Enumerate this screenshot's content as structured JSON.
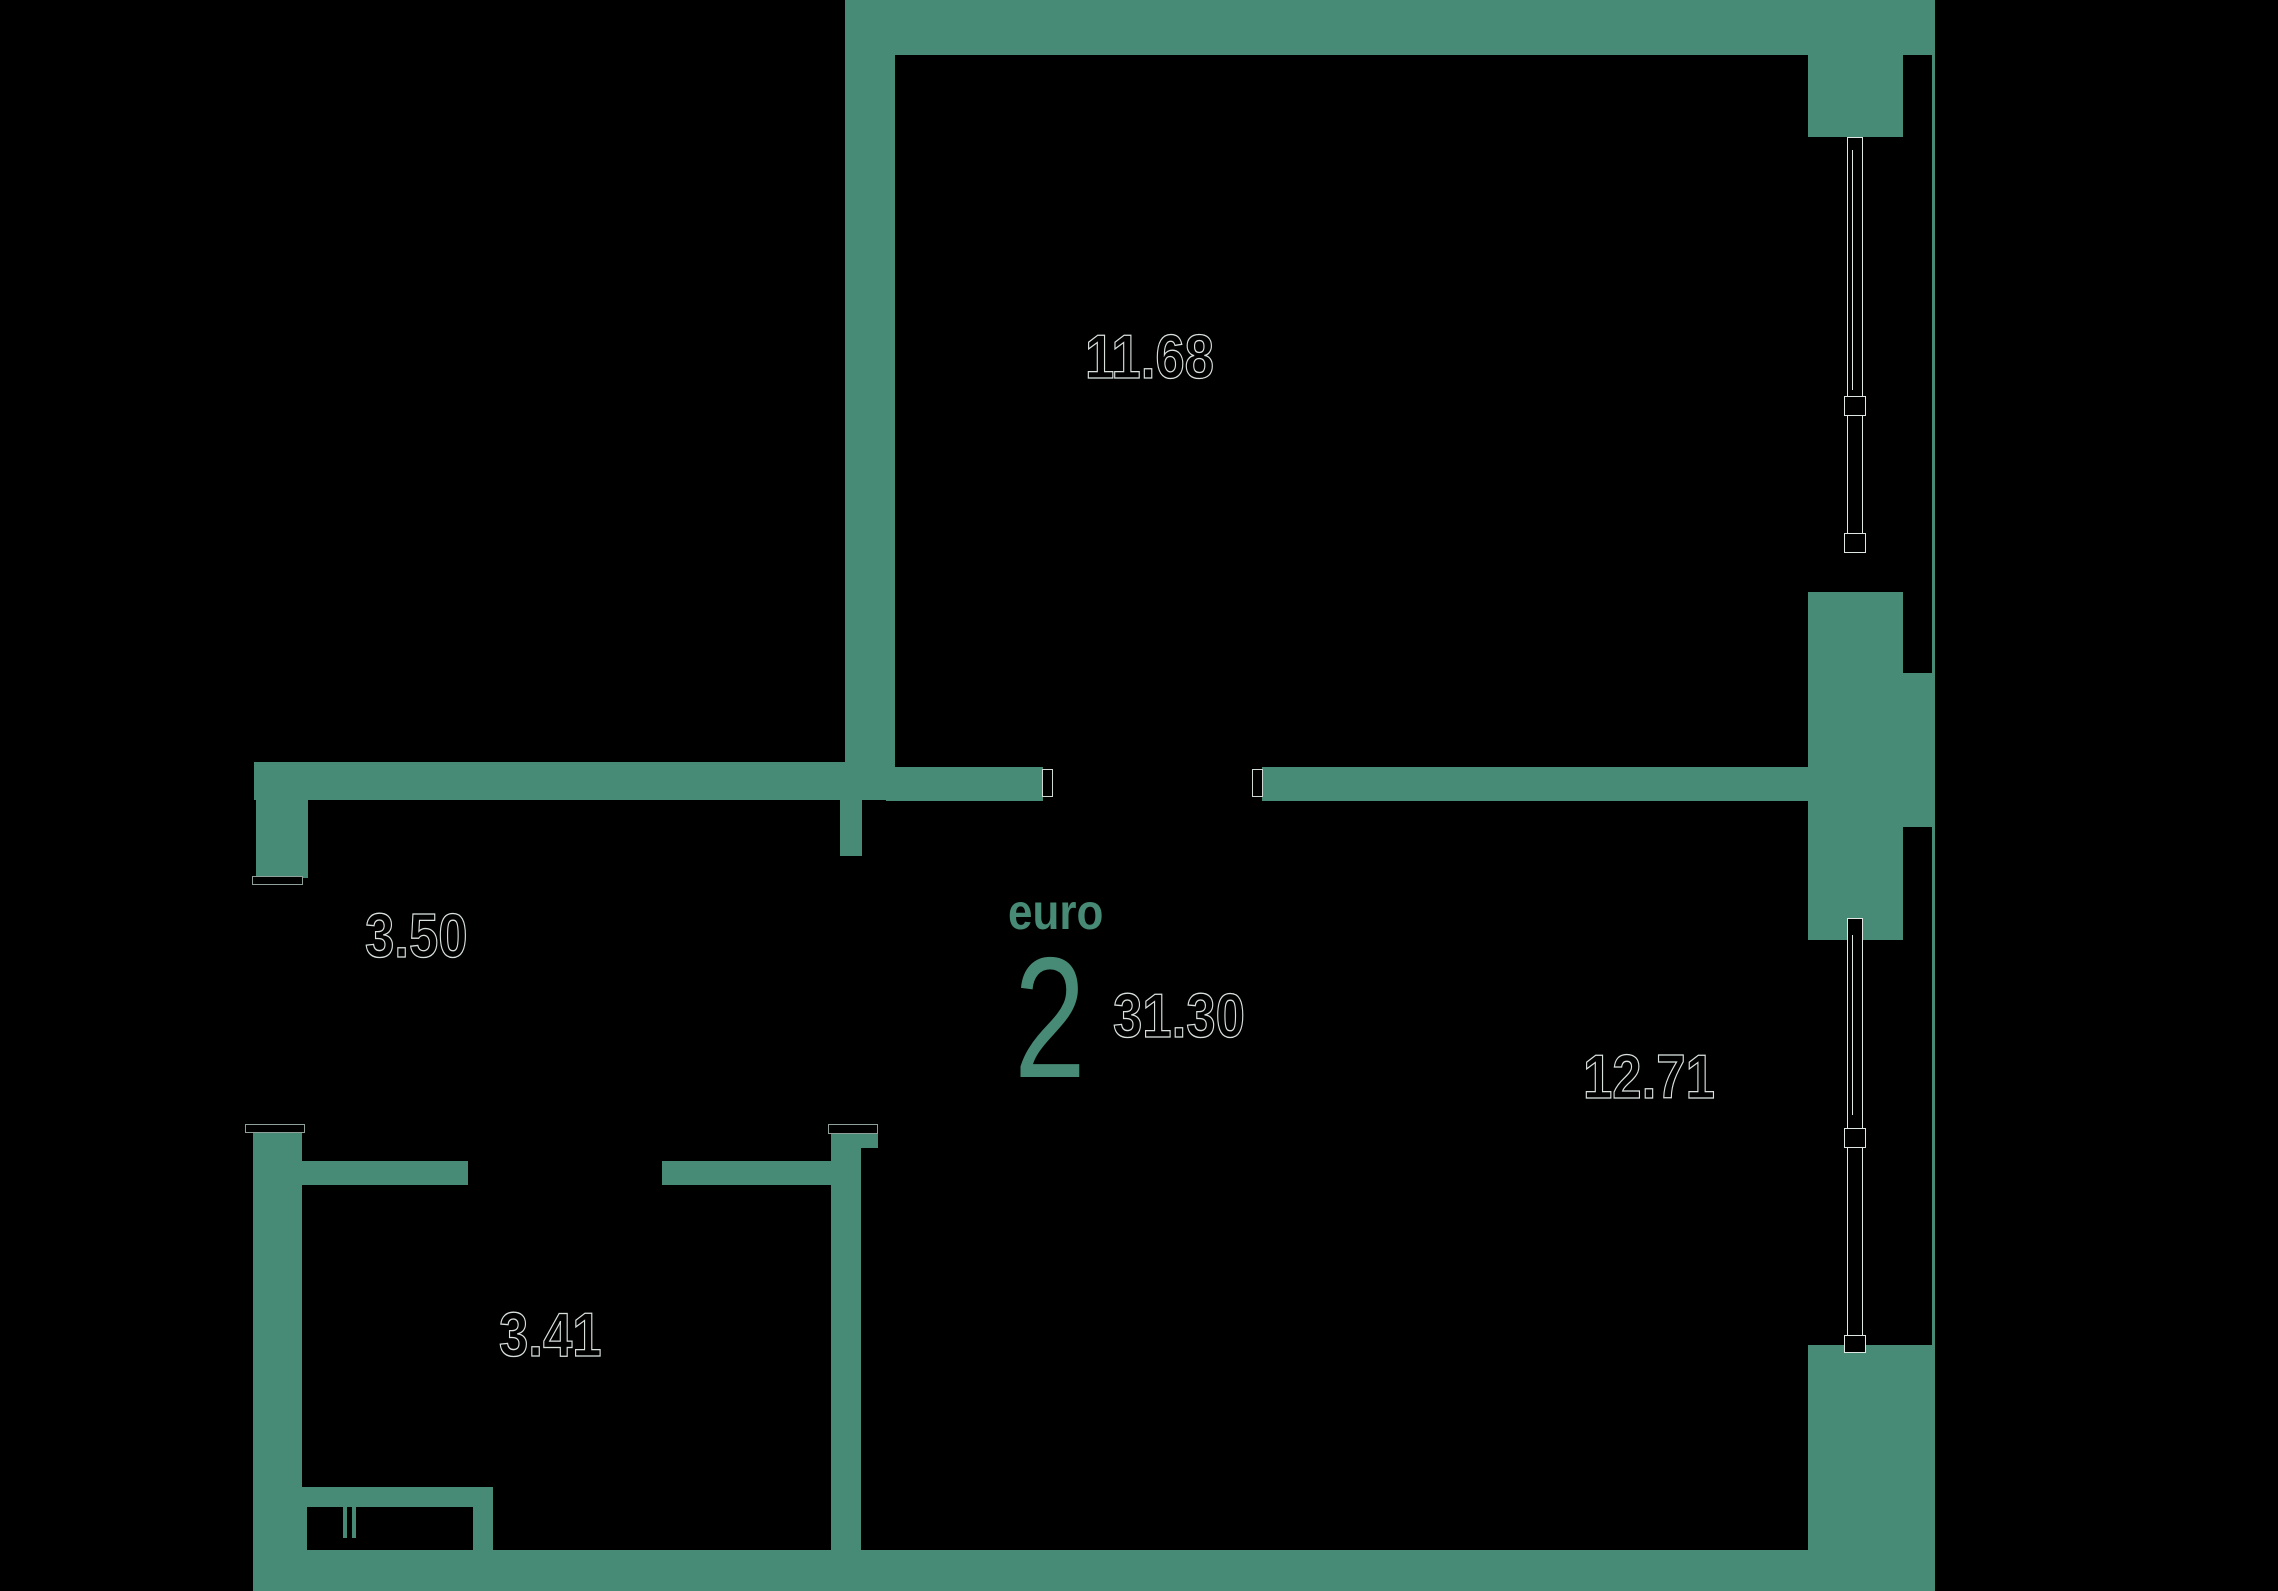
{
  "plan": {
    "format_label": "euro",
    "format_rooms": "2",
    "total_area": "31.30",
    "rooms": [
      {
        "name": "bedroom",
        "area": "11.68"
      },
      {
        "name": "hallway",
        "area": "3.50"
      },
      {
        "name": "bathroom",
        "area": "3.41"
      },
      {
        "name": "kitchen-living-room",
        "area": "12.71"
      }
    ],
    "colors": {
      "wall": "#478a75",
      "background": "#000000",
      "label_outline": "#d9e1dd",
      "accent_text": "#478a75"
    }
  }
}
